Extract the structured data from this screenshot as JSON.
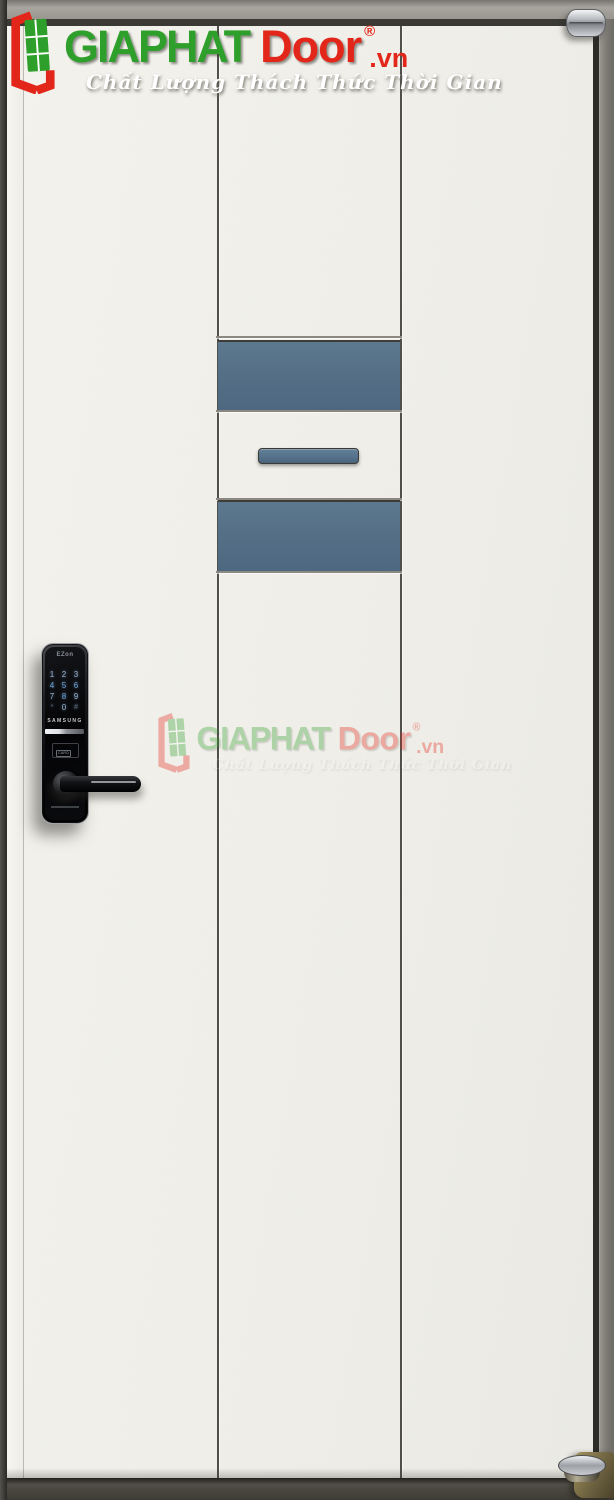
{
  "brand": {
    "name_primary": "GIAPHAT",
    "name_secondary": "Door",
    "registered_mark": "®",
    "domain_suffix": ".vn",
    "tagline": "Chất Lượng Thách Thức Thời Gian",
    "colors": {
      "green": "#2f9f2b",
      "red": "#e3261a",
      "tagline": "#ffffff"
    }
  },
  "door": {
    "leaf_color": "#efeee8",
    "accent_panel_color": "#546f86",
    "frame_color": "#7d7a74",
    "panel_columns": 3,
    "accent_panels": [
      "upper-center",
      "lower-center"
    ],
    "handle_slot": "horizontal-recessed-bar"
  },
  "lock": {
    "brand_small": "EZon",
    "brand": "SAMSUNG",
    "card_label": "CARD",
    "keypad": [
      "1",
      "2",
      "3",
      "4",
      "5",
      "6",
      "7",
      "8",
      "9",
      "*",
      "0",
      "#"
    ],
    "body_color": "#0a0a0c"
  },
  "hardware": {
    "top_hinge": "chrome-hinge",
    "bottom_pivot": "brass-floor-pivot"
  }
}
